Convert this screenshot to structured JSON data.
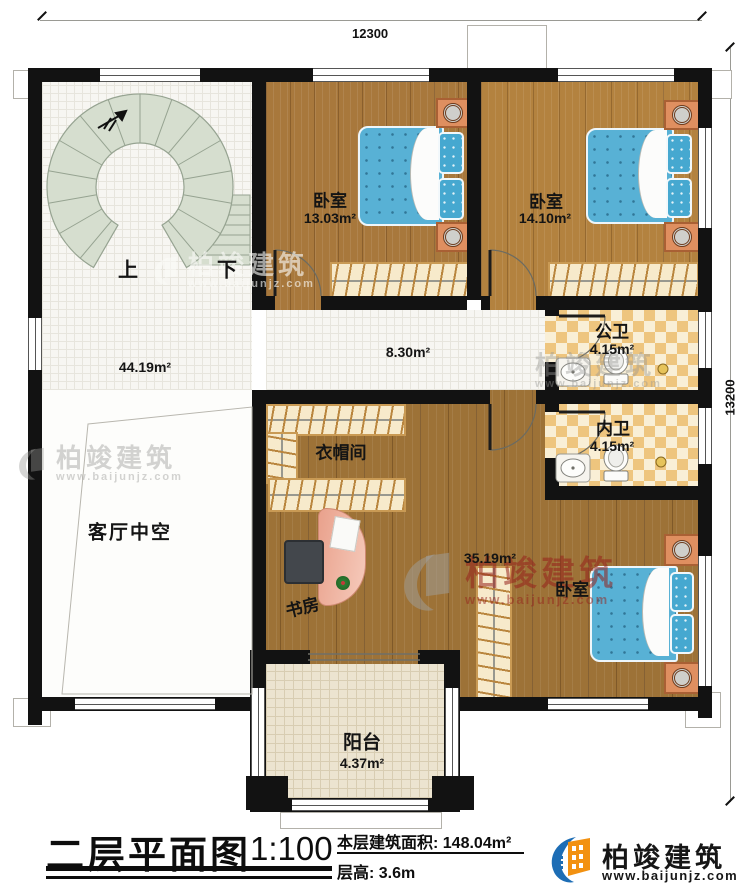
{
  "dimensions": {
    "top": "12300",
    "right": "13200"
  },
  "stairs": {
    "up": "上",
    "down": "下"
  },
  "rooms": {
    "bedroom1": {
      "name": "卧室",
      "area": "13.03m²"
    },
    "bedroom2": {
      "name": "卧室",
      "area": "14.10m²"
    },
    "hallway": {
      "area": "44.19m²"
    },
    "corridor": {
      "area": "8.30m²"
    },
    "public_bath": {
      "name": "公卫",
      "area": "4.15m²"
    },
    "inner_bath": {
      "name": "内卫",
      "area": "4.15m²"
    },
    "living_void": {
      "name": "客厅中空"
    },
    "cloakroom": {
      "name": "衣帽间"
    },
    "study": {
      "name": "书房"
    },
    "master_bedroom": {
      "name": "卧室",
      "area": "35.19m²"
    },
    "balcony": {
      "name": "阳台",
      "area": "4.37m²"
    }
  },
  "title_block": {
    "title": "二层平面图",
    "scale": "1:100",
    "floor_area": "本层建筑面积: 148.04m²",
    "floor_height": "层高: 3.6m"
  },
  "brand": {
    "name": "柏竣建筑",
    "website": "www.baijunjz.com"
  },
  "colors": {
    "wall": "#121212",
    "wood_floor": "#a8783c",
    "tile_floor": "#f7f6f2",
    "bath_tile": "#eec57e",
    "bed_blue": "#58b1d5",
    "stair_green": "#d6decf",
    "logo_blue": "#1d6db5",
    "logo_orange": "#f29111"
  }
}
